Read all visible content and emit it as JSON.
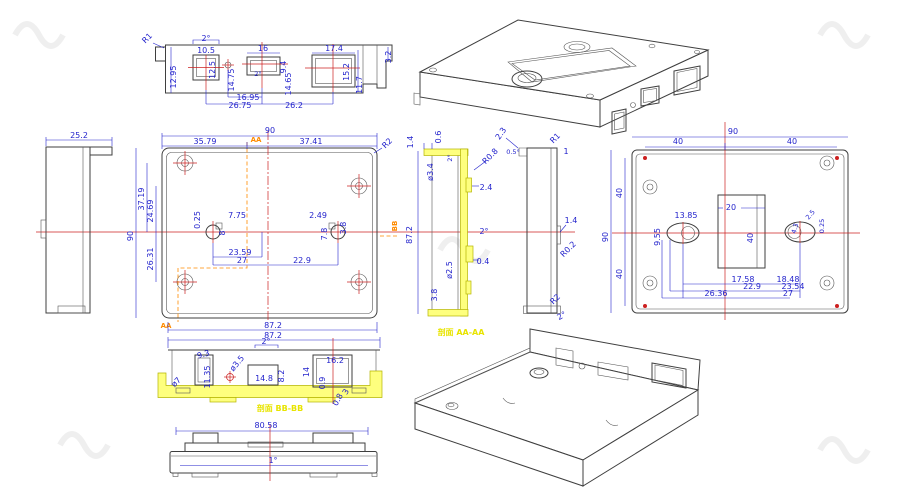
{
  "colors": {
    "dimension_blue": "#2323cc",
    "outline_gray": "#3f3f3f",
    "centerline_red": "#cc2020",
    "section_highlight_yellow": "#feff7e",
    "section_label_yellow": "#e8e400",
    "cutline_orange": "#ff8b00"
  },
  "section_labels": {
    "aa": "剖面 AA-AA",
    "bb": "剖面 BB-BB",
    "aa_marker": "AA",
    "bb_marker": "BB"
  },
  "views": {
    "top_elevation": {
      "r1": "R1",
      "draft_top": "2°",
      "slot1_w": "10.5",
      "slot1_h": "12.5",
      "edge_h": "12.95",
      "hole_c": "14.75",
      "slot2_w": "16",
      "slot2_h": "9.4",
      "slot2_draft": "2°",
      "dim_1465": "14.65",
      "dim_1695": "16.95",
      "dim_2675": "26.75",
      "dim_262": "26.2",
      "slot3_w": "17.4",
      "slot3_h": "15.2",
      "dim_117": "11.7",
      "dim_32": "3.2"
    },
    "left_side": {
      "depth": "25.2"
    },
    "front": {
      "width": "90",
      "off_left": "35.79",
      "off_right": "37.41",
      "corner_r": "R2",
      "dim_3719": "37.19",
      "dim_2469": "24.69",
      "dim_2631": "26.31",
      "height": "90",
      "dim_025": "0.25",
      "dim_775": "7.75",
      "dim_8": "8",
      "dim_2359": "23.59",
      "dim_27": "27",
      "dim_229": "22.9",
      "dim_249": "2.49",
      "dim_78": "7.8",
      "dim_38": "3.8",
      "width_outer": "87.2"
    },
    "section_aa": {
      "dim_14": "1.4",
      "dim_06": "0.6",
      "dim_2deg_top": "2°",
      "dia_34": "ø3.4",
      "r_08": "R0.8",
      "dim_24": "2.4",
      "height": "87.2",
      "dim_2deg_mid": "2°",
      "dim_04": "0.4",
      "dia_25": "ø2.5",
      "dim_38": "3.8"
    },
    "right_side": {
      "dim_23": "2.3",
      "dim_05deg": "0.5°",
      "r1": "R1",
      "dim_1": "1",
      "dim_14": "1.4",
      "r_02": "R0.2",
      "r2": "R2",
      "draft": "2°"
    },
    "back": {
      "width": "90",
      "w40_left": "40",
      "w40_right": "40",
      "height": "90",
      "h40_top": "40",
      "h40_bottom": "40",
      "window_w": "20",
      "window_h": "40",
      "dim_1385": "13.85",
      "dim_955": "9.55",
      "dim_25": "2.5",
      "dim_025": "0.25",
      "dim_43": "4.3",
      "dim_1758": "17.58",
      "dim_1848": "18.48",
      "dim_229": "22.9",
      "dim_2354": "23.54",
      "dim_2636": "26.36",
      "dim_27": "27"
    },
    "section_bb": {
      "width": "87.2",
      "draft": "2°",
      "dia_7": "ø7",
      "dim_93": "9.3",
      "dim_1135": "11.35",
      "dia_35": "ø3.5",
      "dim_148": "14.8",
      "dim_82": "8.2",
      "dim_14": "14",
      "dim_162": "16.2",
      "dim_09": "0.9",
      "dim_08": "0.8",
      "dim_3": "3"
    },
    "bottom_elevation": {
      "width": "80.58",
      "draft": "1°"
    }
  }
}
